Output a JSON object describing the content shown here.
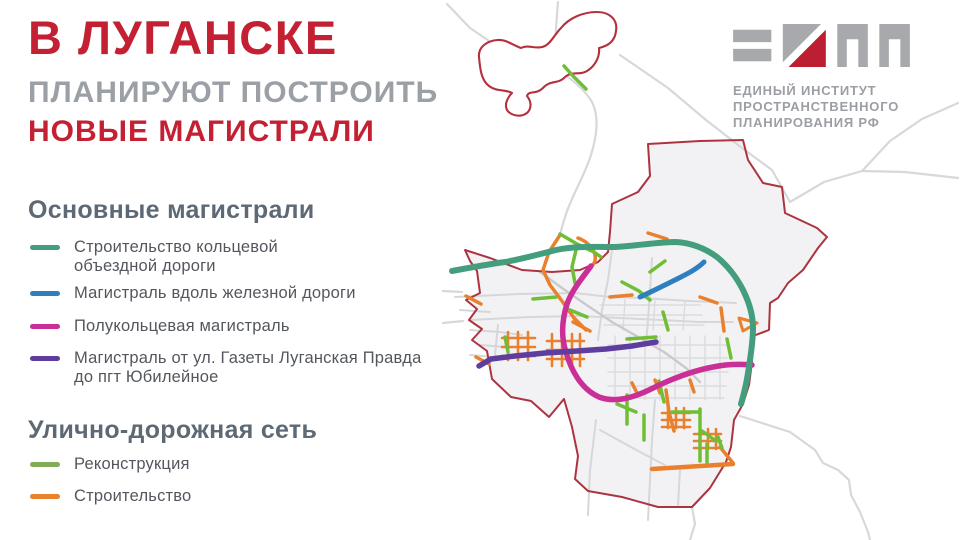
{
  "header": {
    "title_accent": "В ЛУГАНСКЕ",
    "title_sub": "ПЛАНИРУЮТ ПОСТРОИТЬ",
    "title_accent2": "НОВЫЕ МАГИСТРАЛИ",
    "accent_color": "#c32133",
    "sub_color": "#9ba0a6"
  },
  "legend": {
    "sections": [
      {
        "heading": "Основные магистрали",
        "items": [
          {
            "id": "ring-road",
            "lines": [
              "Строительство кольцевой",
              "объездной дороги"
            ],
            "color": "#449e7d"
          },
          {
            "id": "rail-highway",
            "lines": [
              "Магистраль вдоль железной дороги"
            ],
            "color": "#2d7fc0"
          },
          {
            "id": "semi-ring",
            "lines": [
              "Полукольцевая магистраль"
            ],
            "color": "#c92f97"
          },
          {
            "id": "gazeta-yubileynoye",
            "lines": [
              "Магистраль от ул. Газеты Луганская Правда",
              "до пгт Юбилейное"
            ],
            "color": "#5e3d9e"
          }
        ]
      },
      {
        "heading": "Улично-дорожная сеть",
        "items": [
          {
            "id": "reconstruction",
            "lines": [
              "Реконструкция"
            ],
            "color": "#82ab5a"
          },
          {
            "id": "construction",
            "lines": [
              "Строительство"
            ],
            "color": "#e8822f"
          }
        ]
      }
    ]
  },
  "logo": {
    "glyphs": "EIPP-monogram",
    "gray": "#a7a9ad",
    "red": "#bc1f31",
    "lines": [
      "ЕДИНЫЙ ИНСТИТУТ",
      "ПРОСТРАНСТВЕННОГО",
      "ПЛАНИРОВАНИЯ РФ"
    ]
  },
  "map": {
    "title": "Карта Луганска с планируемыми магистралями",
    "colors": {
      "boundary": "#ac3440",
      "settlement_outline": "#b5303d",
      "city_fill": "#f2f2f4",
      "street": "#d6d7d9",
      "street_light": "#dadbdd",
      "street_dark": "#c9cacd",
      "highway": "#d7d8da",
      "ring_road": "#449e7d",
      "rail_highway": "#2d7fc0",
      "semi_ring": "#c92f97",
      "gazeta_route": "#5e3d9e",
      "reconstruction": "#6fbe35",
      "construction": "#e8802e"
    }
  }
}
